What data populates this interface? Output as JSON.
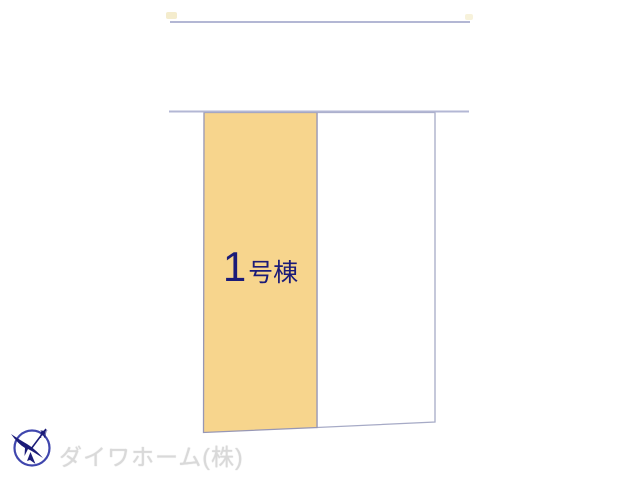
{
  "site_plan": {
    "boundary_color": "#B3B7D4",
    "plots": [
      {
        "name": "unit-1",
        "label_number": "1",
        "label_suffix": "号棟",
        "fill": "#F7D58D",
        "label_color": "#1B1B78"
      },
      {
        "name": "adjacent-lot",
        "fill": "#FFFFFF"
      }
    ]
  },
  "compass": {
    "north_label": "N",
    "color": "#1B1B78"
  },
  "footer": {
    "company_name": "ダイワホーム(株)",
    "text_color": "#D9D9D9"
  }
}
